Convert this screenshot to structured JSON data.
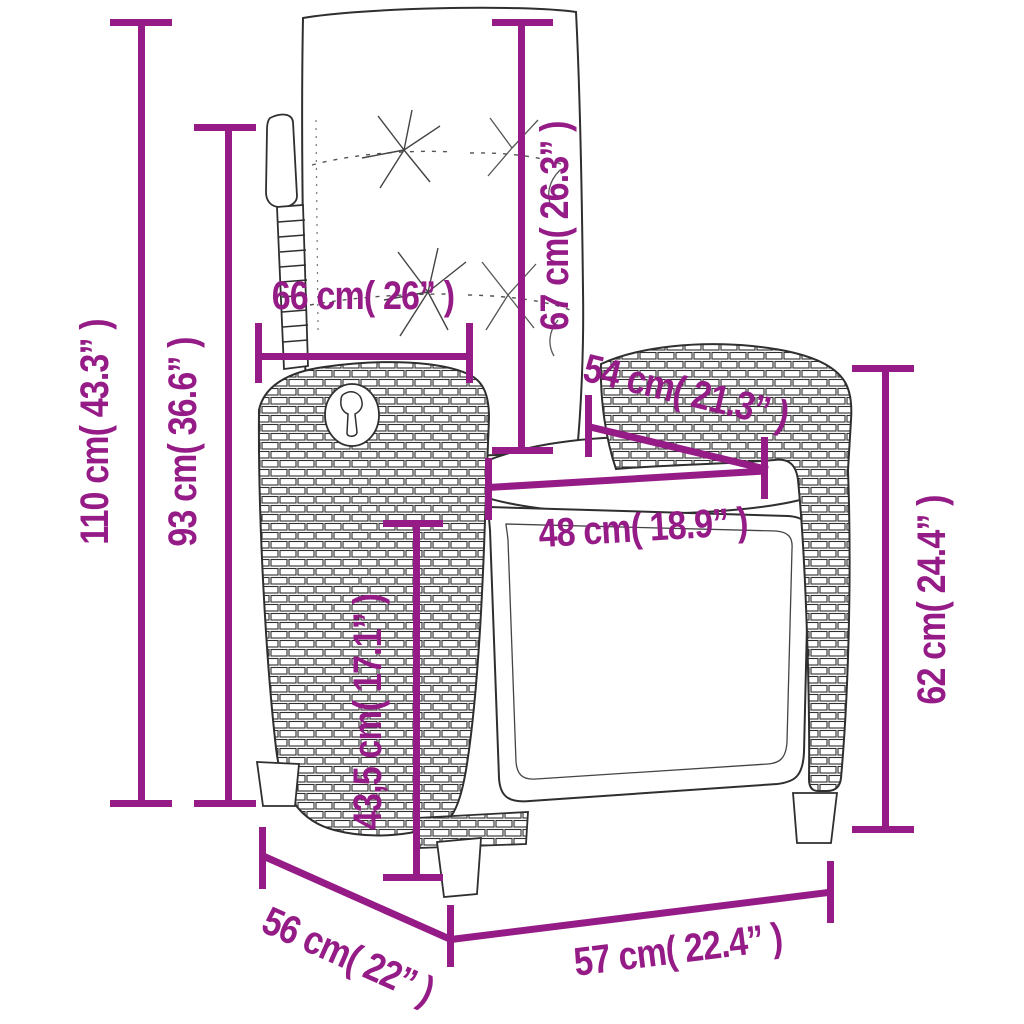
{
  "style": {
    "dimension_color": "#951b87",
    "drawing_outline_color": "#2f2f2f",
    "background": "#ffffff"
  },
  "dimensions": [
    {
      "id": "height-110",
      "label": "110 cm( 43.3” )"
    },
    {
      "id": "height-93",
      "label": "93 cm( 36.6” )"
    },
    {
      "id": "width-66",
      "label": "66 cm( 26” )"
    },
    {
      "id": "length-67",
      "label": "67 cm( 26.3” )"
    },
    {
      "id": "length-54",
      "label": "54 cm( 21.3” )"
    },
    {
      "id": "width-48",
      "label": "48 cm( 18.9” )"
    },
    {
      "id": "height-43-5",
      "label": "43,5 cm( 17.1” )"
    },
    {
      "id": "height-62",
      "label": "62 cm( 24.4” )"
    },
    {
      "id": "depth-56",
      "label": "56 cm( 22” )"
    },
    {
      "id": "width-57",
      "label": "57 cm( 22.4” )"
    }
  ]
}
